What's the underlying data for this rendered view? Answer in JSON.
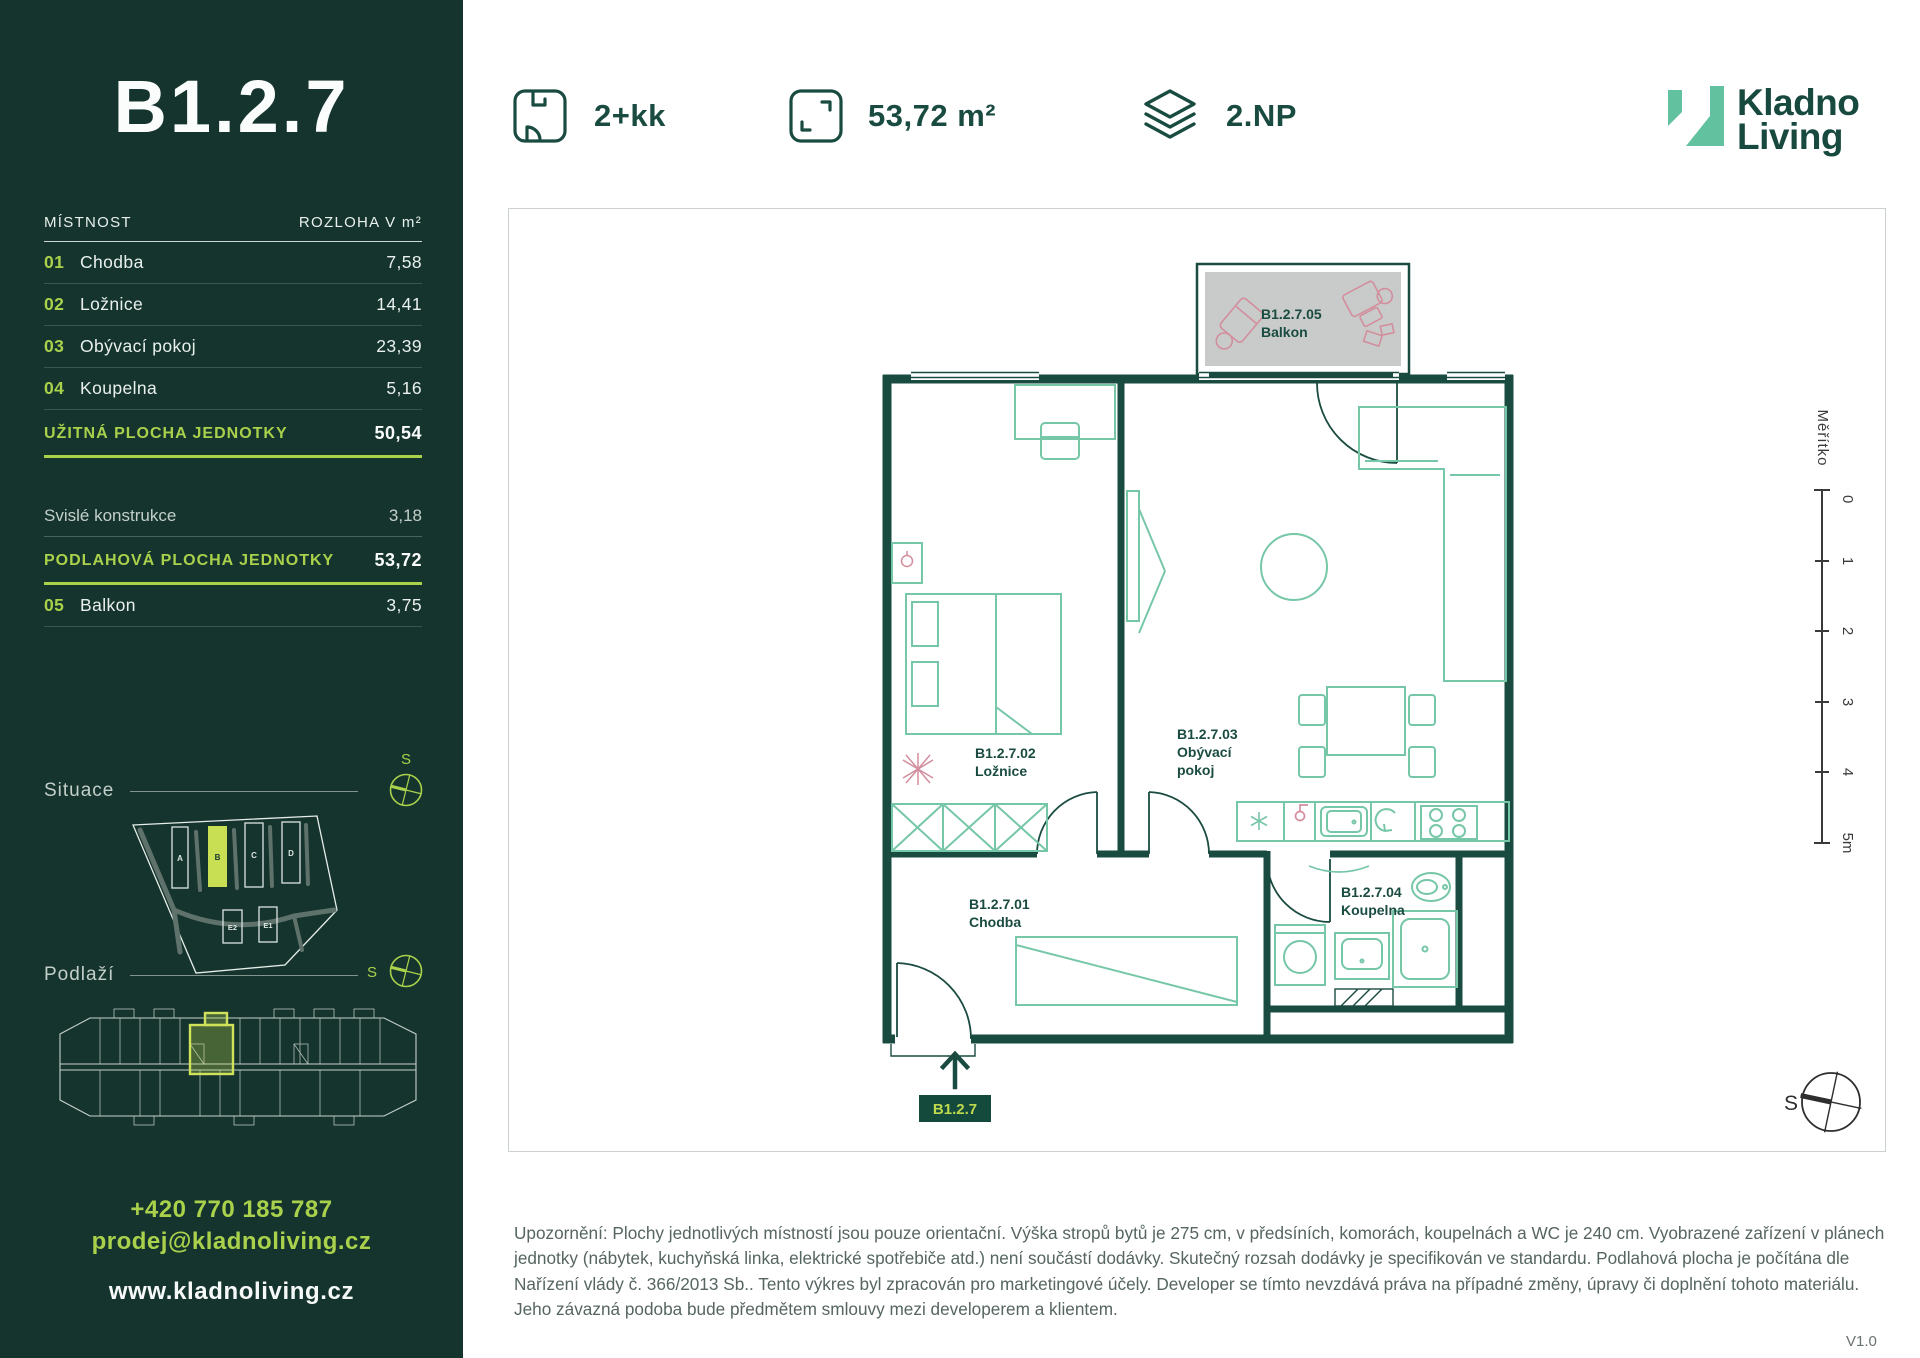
{
  "sidebar": {
    "unit_title": "B1.2.7",
    "table": {
      "col_room": "MÍSTNOST",
      "col_area": "ROZLOHA V m²",
      "rows": [
        {
          "num": "01",
          "name": "Chodba",
          "area": "7,58"
        },
        {
          "num": "02",
          "name": "Ložnice",
          "area": "14,41"
        },
        {
          "num": "03",
          "name": "Obývací pokoj",
          "area": "23,39"
        },
        {
          "num": "04",
          "name": "Koupelna",
          "area": "5,16"
        }
      ],
      "usable_label": "UŽITNÁ PLOCHA JEDNOTKY",
      "usable_value": "50,54",
      "vertical_label": "Svislé konstrukce",
      "vertical_value": "3,18",
      "floor_area_label": "PODLAHOVÁ PLOCHA JEDNOTKY",
      "floor_area_value": "53,72",
      "balcony_row": {
        "num": "05",
        "name": "Balkon",
        "area": "3,75"
      }
    },
    "situace_label": "Situace",
    "site_map": {
      "labels": [
        "A",
        "B",
        "C",
        "D",
        "E2",
        "E1"
      ],
      "highlighted": "B"
    },
    "podlazi_label": "Podlaží",
    "contact": {
      "phone": "+420 770 185 787",
      "email": "prodej@kladnoliving.cz",
      "web": "www.kladnoliving.cz"
    }
  },
  "header": {
    "specs": [
      {
        "icon": "layout-icon",
        "label": "2+kk"
      },
      {
        "icon": "area-icon",
        "label": "53,72 m²"
      },
      {
        "icon": "floor-icon",
        "label": "2.NP"
      }
    ],
    "brand": {
      "line1": "Kladno",
      "line2": "Living"
    }
  },
  "plan": {
    "rooms": {
      "chodba": {
        "code": "B1.2.7.01",
        "name": "Chodba"
      },
      "loznice": {
        "code": "B1.2.7.02",
        "name": "Ložnice"
      },
      "obyvaci": {
        "code": "B1.2.7.03",
        "name_line1": "Obývací",
        "name_line2": "pokoj"
      },
      "koupelna": {
        "code": "B1.2.7.04",
        "name": "Koupelna"
      },
      "balkon": {
        "code": "B1.2.7.05",
        "name": "Balkon"
      }
    },
    "badge": "B1.2.7",
    "scale": {
      "title": "Měřítko",
      "ticks": [
        "0",
        "1",
        "2",
        "3",
        "4",
        "5m"
      ]
    },
    "compass_label": "S"
  },
  "footer": {
    "disclaimer": "Upozornění: Plochy jednotlivých místností jsou pouze orientační. Výška stropů bytů je 275 cm, v předsíních, komorách, koupelnách a WC je 240 cm. Vyobrazené zařízení v plánech jednotky (nábytek, kuchyňská linka, elektrické spotřebiče atd.) není součástí dodávky. Skutečný rozsah dodávky je specifikován ve standardu. Podlahová plocha je počítána dle Nařízení vlády č. 366/2013 Sb.. Tento výkres byl zpracován pro marketingové účely. Developer se tímto nevzdává práva na případné změny, úpravy či doplnění tohoto materiálu. Jeho závazná podoba bude předmětem smlouvy mezi developerem a klientem.",
    "version": "V1.0"
  },
  "colors": {
    "sidebar_bg": "#15342D",
    "accent_lime": "#A9D14B",
    "brand_dark_green": "#1A4B41",
    "brand_mint": "#62C19E",
    "furniture_mint": "#76C7A7",
    "accent_pink": "#D28E9D",
    "balcony_gray": "#C9CBCA"
  }
}
